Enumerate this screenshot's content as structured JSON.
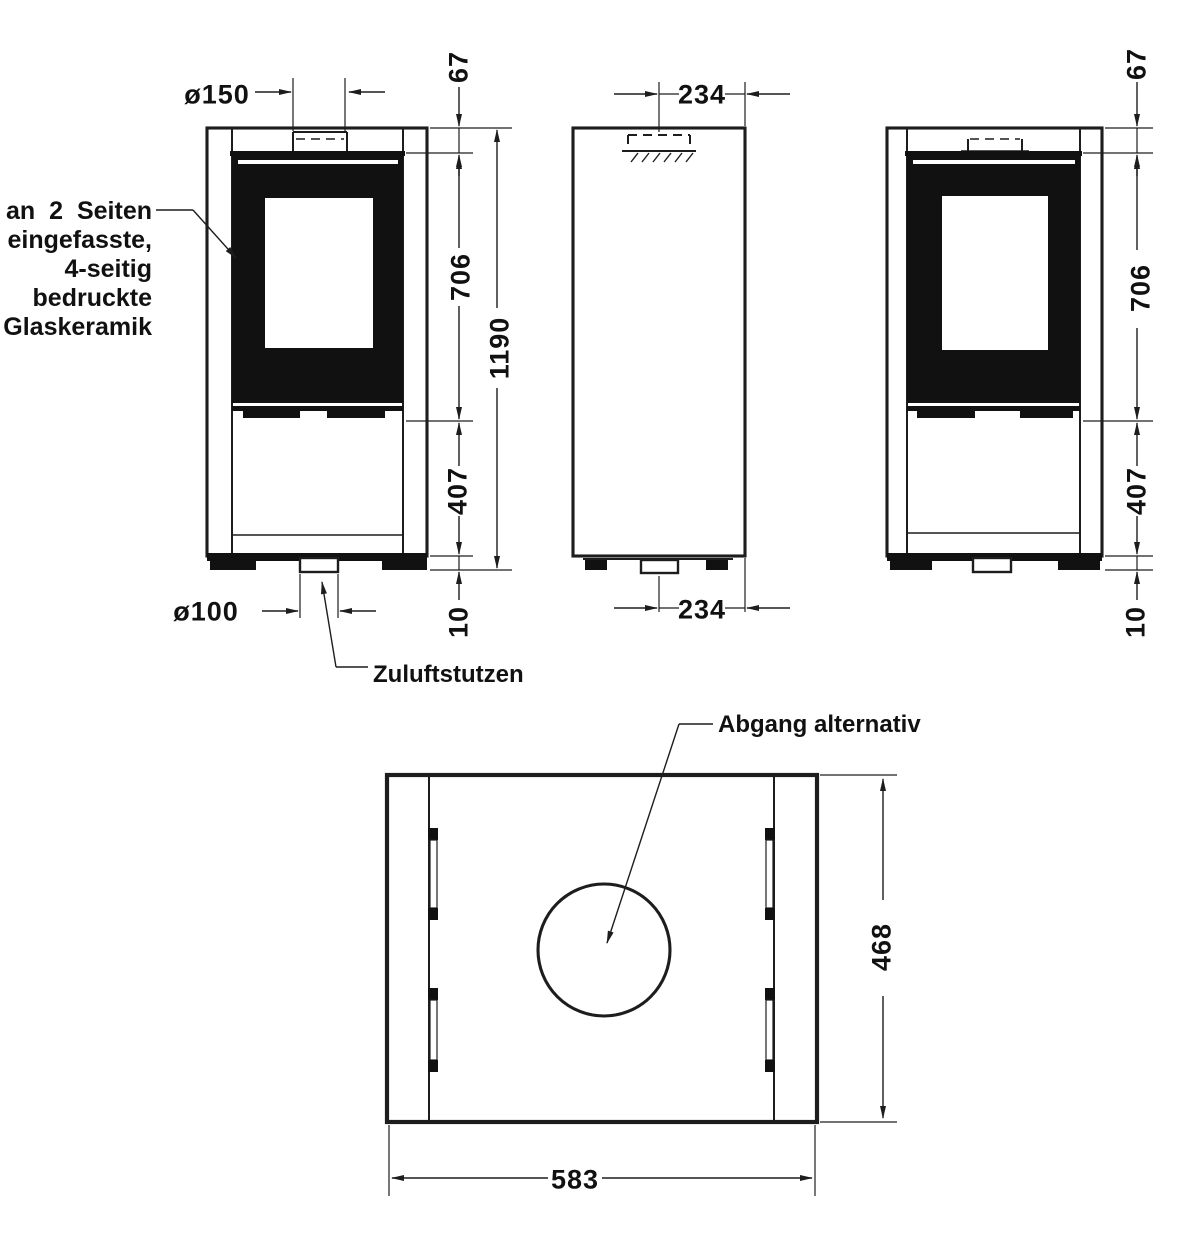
{
  "note_glass": {
    "lines": [
      "an 2 Seiten",
      "eingefasste,",
      "4-seitig",
      "bedruckte",
      "Glaskeramik"
    ]
  },
  "labels": {
    "zuluftstutzen": "Zuluftstutzen",
    "abgang": "Abgang alternativ"
  },
  "front": {
    "flue_diameter": "ø150",
    "inlet_diameter": "ø100",
    "top_offset": "67",
    "glass_height": "706",
    "total_height": "1190",
    "lower_height": "407",
    "base_height": "10"
  },
  "side": {
    "top_flue_offset": "234",
    "bottom_inlet_offset": "234"
  },
  "rear": {
    "top_offset": "67",
    "glass_height": "706",
    "lower_height": "407",
    "base_height": "10"
  },
  "plan": {
    "depth": "468",
    "width": "583"
  },
  "colors": {
    "line": "#1d1d1d",
    "glass_fill": "#111111",
    "background": "#ffffff"
  }
}
